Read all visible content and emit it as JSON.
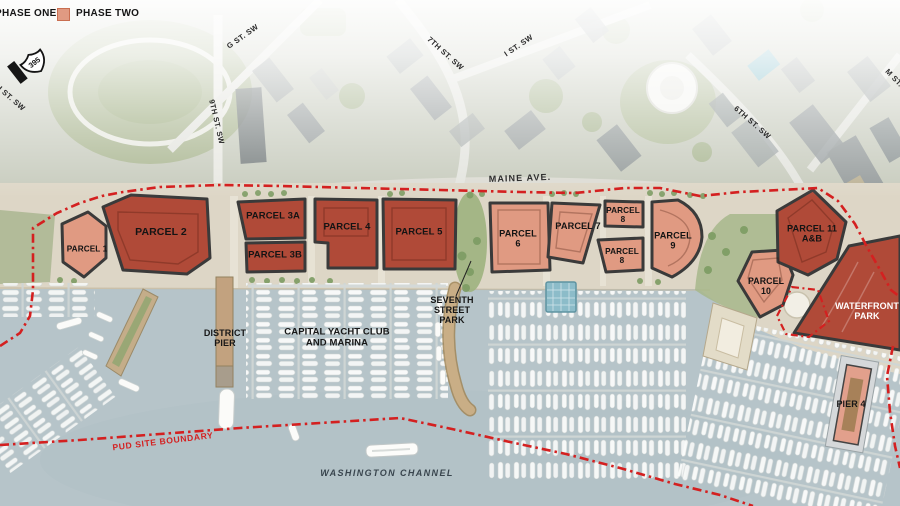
{
  "legend": {
    "phase_one_label": "PHASE ONE",
    "phase_two_label": "PHASE TWO"
  },
  "colors": {
    "phase_one": "#b04a38",
    "phase_two": "#e09a82",
    "boundary_red": "#d42020"
  },
  "highway_shield": {
    "number": "395"
  },
  "streets": {
    "h_st": "H ST. SW",
    "g_st": "G ST. SW",
    "ninth_st": "9TH ST. SW",
    "seventh_st": "7TH ST. SW",
    "i_st": "I ST. SW",
    "sixth_st": "6TH ST. SW",
    "m_st": "M ST. SW",
    "maine_ave": "MAINE AVE."
  },
  "parcels": {
    "p1": "PARCEL 1",
    "p2": "PARCEL 2",
    "p3a": "PARCEL 3A",
    "p3b": "PARCEL 3B",
    "p4": "PARCEL 4",
    "p5": "PARCEL 5",
    "p6": "PARCEL\n6",
    "p7": "PARCEL 7",
    "p8_upper": "PARCEL\n8",
    "p8_lower": "PARCEL\n8",
    "p9": "PARCEL\n9",
    "p10": "PARCEL\n10",
    "p11": "PARCEL 11\nA&B"
  },
  "places": {
    "waterfront_park": "WATERFRONT\nPARK",
    "pier4": "PIER 4",
    "district_pier": "DISTRICT\nPIER",
    "capital_yacht_club": "CAPITAL YACHT CLUB\nAND MARINA",
    "seventh_street_park": "SEVENTH\nSTREET\nPARK",
    "washington_channel": "WASHINGTON CHANNEL",
    "pud_site_boundary": "PUD SITE BOUNDARY"
  },
  "phase_assignments": {
    "phase_one": [
      "PARCEL 2",
      "PARCEL 3A",
      "PARCEL 3B",
      "PARCEL 4",
      "PARCEL 5",
      "PARCEL 11 A&B",
      "WATERFRONT PARK",
      "PIER 4"
    ],
    "phase_two": [
      "PARCEL 1",
      "PARCEL 6",
      "PARCEL 7",
      "PARCEL 8",
      "PARCEL 9",
      "PARCEL 10"
    ]
  }
}
